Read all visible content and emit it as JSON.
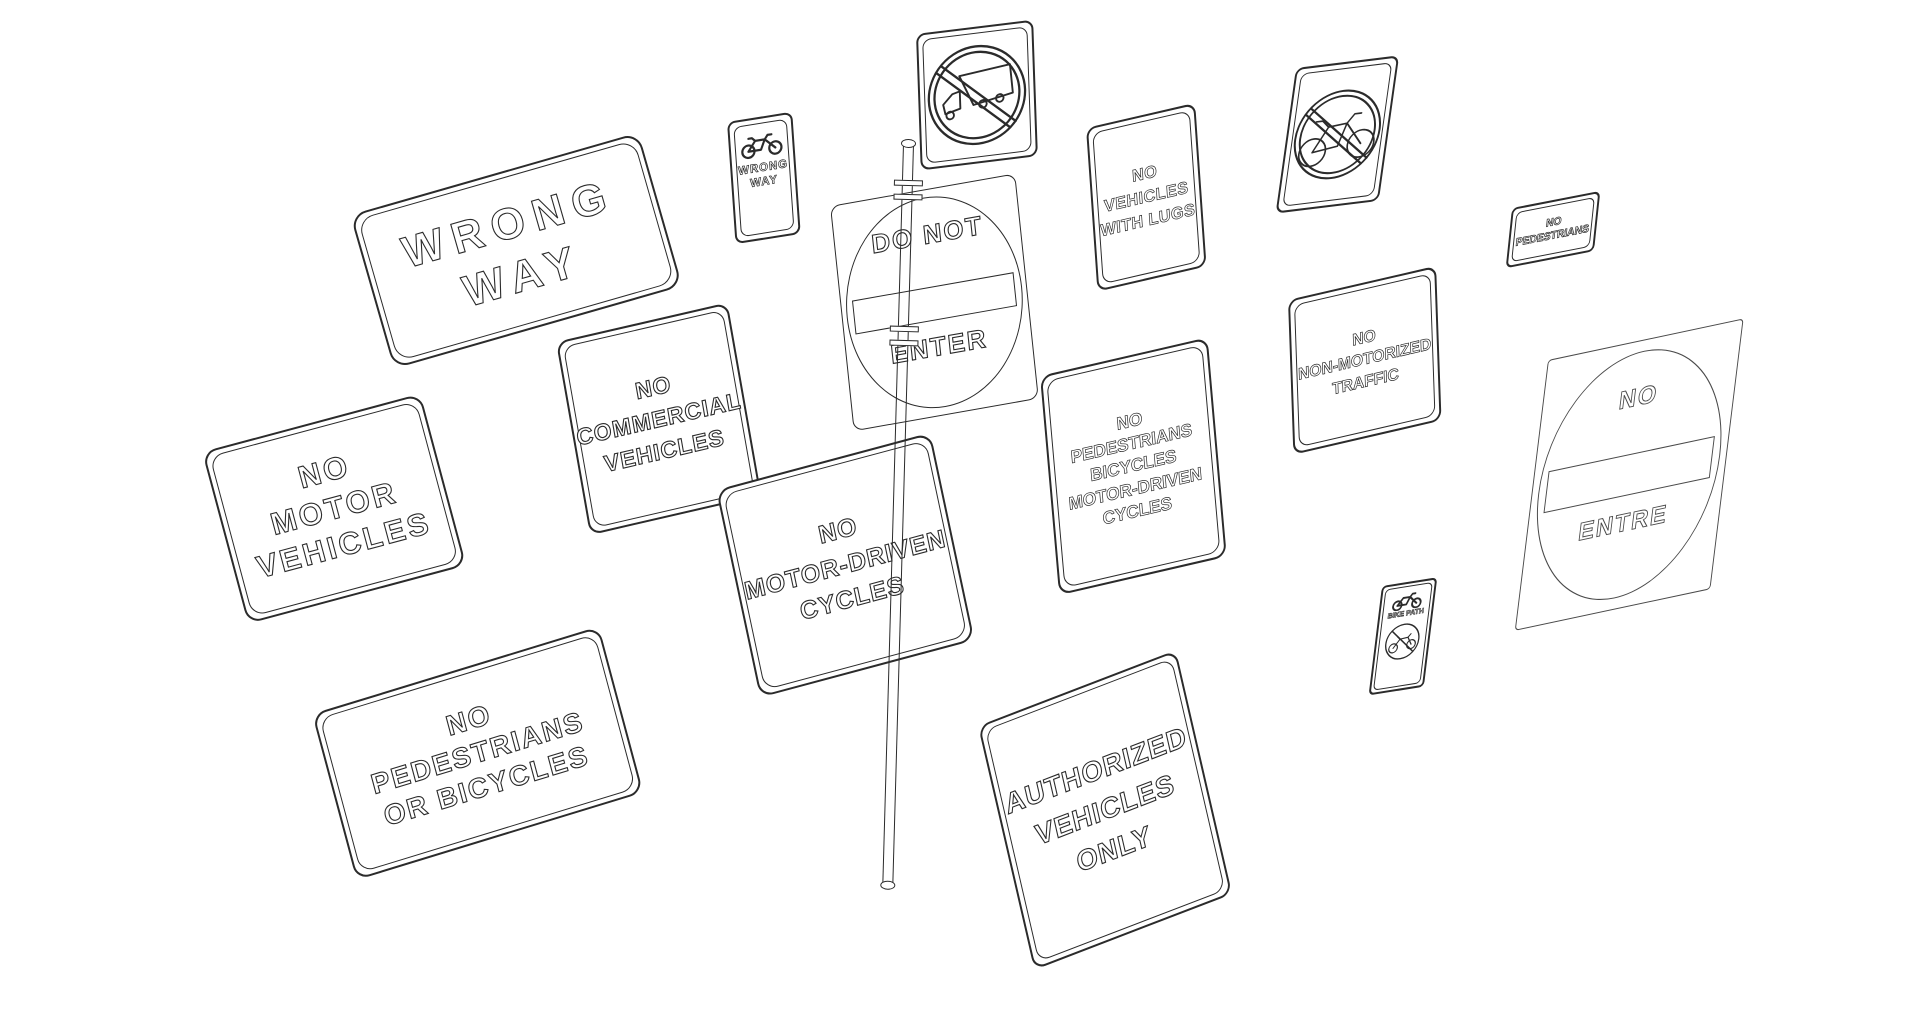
{
  "canvas": {
    "background": "#ffffff",
    "line_color": "#2b2b2b"
  },
  "signs": {
    "wrong_way": {
      "lines": [
        "WRONG",
        "WAY"
      ]
    },
    "bike_wrong_way": {
      "icon": "bicycle-icon",
      "lines": [
        "WRONG",
        "WAY"
      ]
    },
    "no_trucks": {
      "icon": "no-trucks-symbol-icon"
    },
    "do_not_enter": {
      "line_top": "DO NOT",
      "line_bottom": "ENTER"
    },
    "no_vehicles_with_lugs": {
      "lines": [
        "NO",
        "VEHICLES",
        "WITH LUGS"
      ]
    },
    "no_bicycles": {
      "icon": "no-bicycles-symbol-icon"
    },
    "no_pedestrians": {
      "lines": [
        "NO",
        "PEDESTRIANS"
      ]
    },
    "no_non_motorized_traffic": {
      "lines": [
        "NO",
        "NON-MOTORIZED",
        "TRAFFIC"
      ]
    },
    "no_pedestrians_bicycles_motor_driven_cycles": {
      "lines": [
        "NO",
        "PEDESTRIANS",
        "BICYCLES",
        "MOTOR-DRIVEN",
        "CYCLES"
      ]
    },
    "no_commercial_vehicles": {
      "lines": [
        "NO",
        "COMMERCIAL",
        "VEHICLES"
      ]
    },
    "no_motor_vehicles": {
      "lines": [
        "NO",
        "MOTOR",
        "VEHICLES"
      ]
    },
    "no_pedestrians_or_bicycles": {
      "lines": [
        "NO",
        "PEDESTRIANS",
        "OR BICYCLES"
      ]
    },
    "no_motor_driven_cycles": {
      "lines": [
        "NO",
        "MOTOR-DRIVEN",
        "CYCLES"
      ]
    },
    "authorized_vehicles_only": {
      "lines": [
        "AUTHORIZED",
        "VEHICLES",
        "ONLY"
      ]
    },
    "bike_path": {
      "icon": "bicycle-icon",
      "label": "BIKE PATH",
      "icon_bottom": "no-motor-driven-cycles-symbol-icon"
    },
    "no_entre": {
      "line_top": "NO",
      "line_bottom": "ENTRE"
    }
  }
}
